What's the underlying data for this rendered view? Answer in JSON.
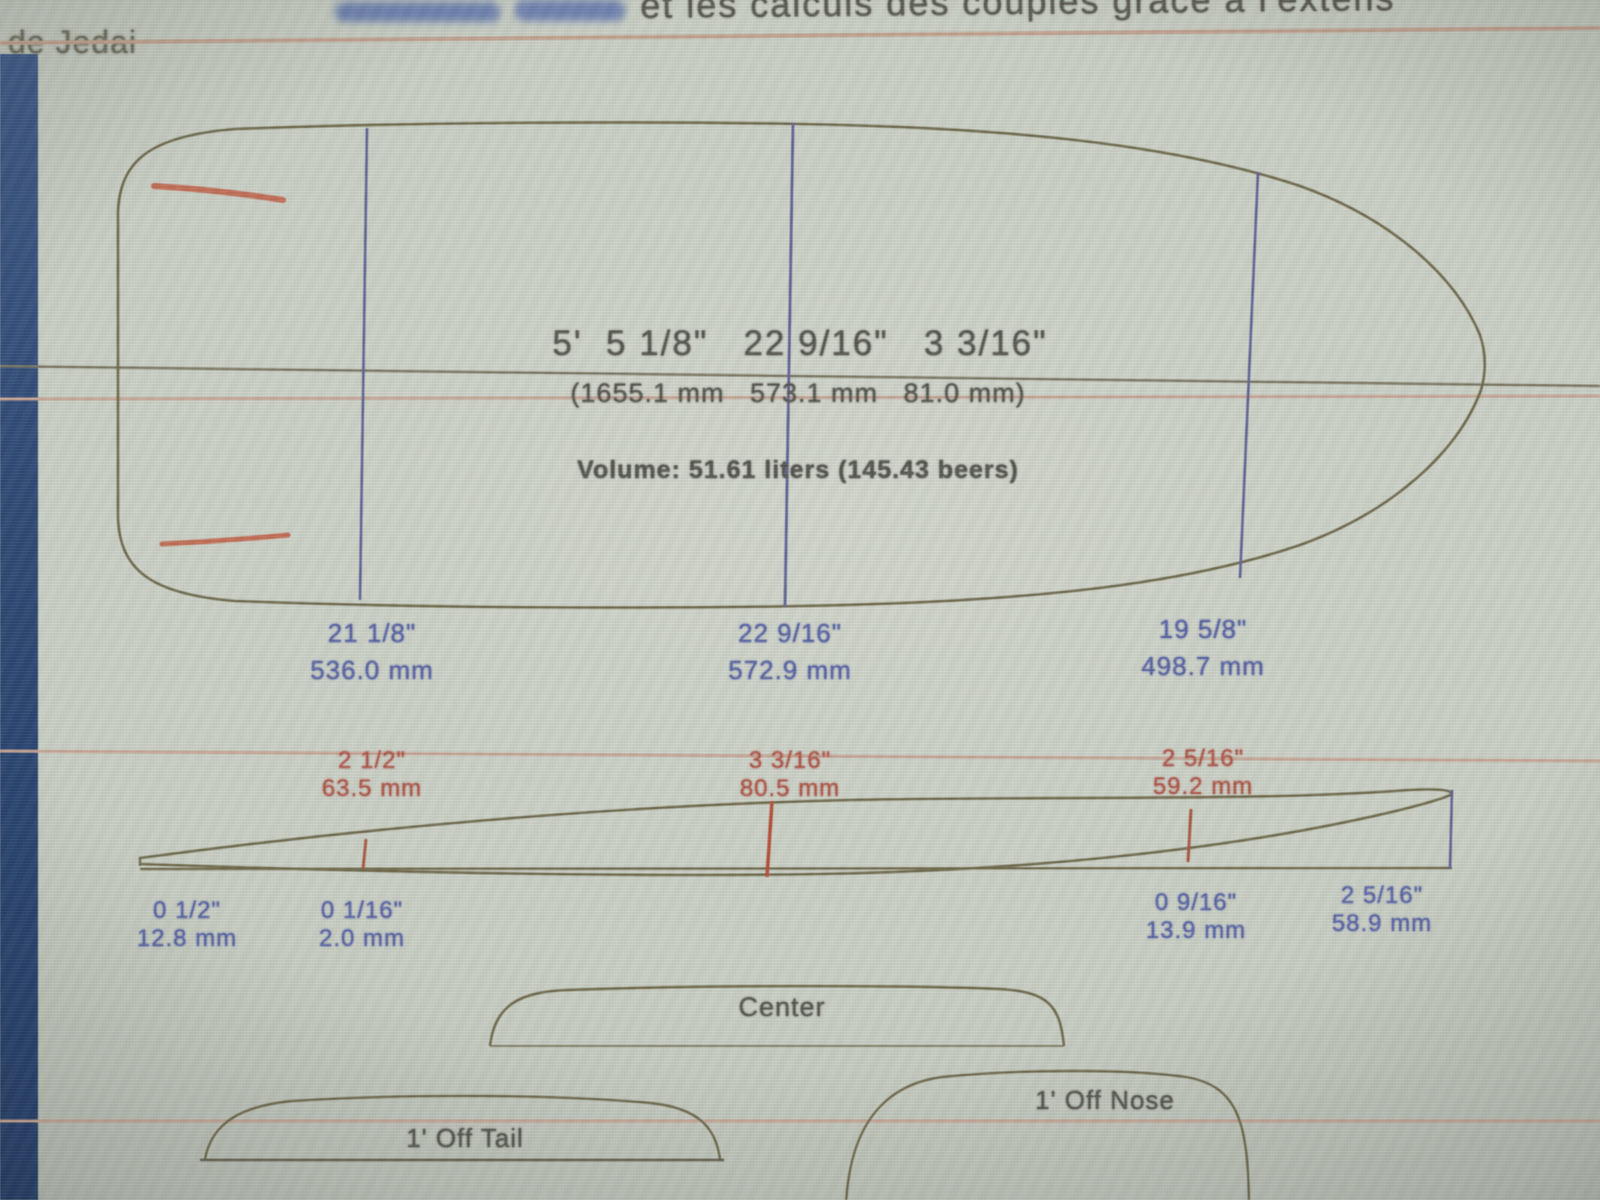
{
  "header": {
    "clipped_line": "et les calculs des couples grâce à l'extens",
    "byline": "de Jedai"
  },
  "board": {
    "dims_imperial": "5'  5 1/8\"   22 9/16\"   3 3/16\"",
    "dims_metric": "(1655.1 mm   573.1 mm   81.0 mm)",
    "volume": "Volume: 51.61 liters (145.43 beers)"
  },
  "plan_widths": [
    {
      "in": "21 1/8\"",
      "mm": "536.0 mm"
    },
    {
      "in": "22 9/16\"",
      "mm": "572.9 mm"
    },
    {
      "in": "19 5/8\"",
      "mm": "498.7 mm"
    }
  ],
  "profile_thickness": [
    {
      "in": "2 1/2\"",
      "mm": "63.5 mm"
    },
    {
      "in": "3 3/16\"",
      "mm": "80.5 mm"
    },
    {
      "in": "2 5/16\"",
      "mm": "59.2 mm"
    }
  ],
  "rocker_heights": [
    {
      "in": "0 1/2\"",
      "mm": "12.8 mm"
    },
    {
      "in": "0 1/16\"",
      "mm": "2.0 mm"
    },
    {
      "in": "0 9/16\"",
      "mm": "13.9 mm"
    },
    {
      "in": "2 5/16\"",
      "mm": "58.9 mm"
    }
  ],
  "sections": {
    "center": "Center",
    "off_tail": "1' Off Tail",
    "off_nose": "1' Off Nose"
  },
  "colors": {
    "measure_blue": "#5560a0",
    "measure_red": "#ad5244",
    "outline_olive": "#6d6747",
    "rule_tan": "#c6a492",
    "bezel_blue": "#2a4570"
  }
}
